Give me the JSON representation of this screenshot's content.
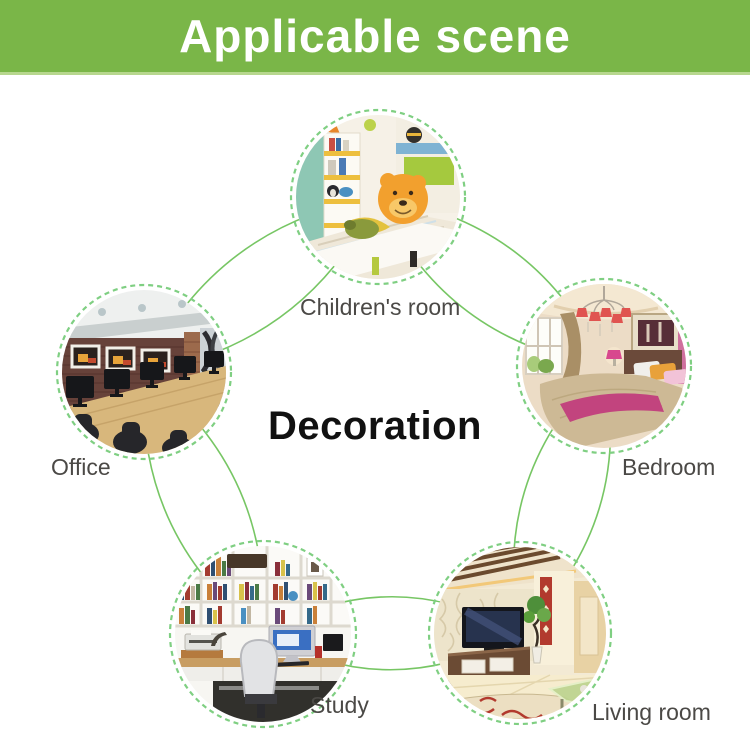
{
  "header": {
    "title": "Applicable scene"
  },
  "center": {
    "label": "Decoration"
  },
  "nodes": [
    {
      "id": "children-room",
      "label": "Children's room"
    },
    {
      "id": "office",
      "label": "Office"
    },
    {
      "id": "bedroom",
      "label": "Bedroom"
    },
    {
      "id": "study",
      "label": "Study"
    },
    {
      "id": "living-room",
      "label": "Living room"
    }
  ],
  "colors": {
    "header_bg": "#7ab648",
    "header_edge": "#b7d78e",
    "header_text": "#ffffff",
    "connector": "#70c35c",
    "circle_dash": "#7fcf82",
    "label_text": "#4b4946",
    "center_text": "#111111"
  }
}
